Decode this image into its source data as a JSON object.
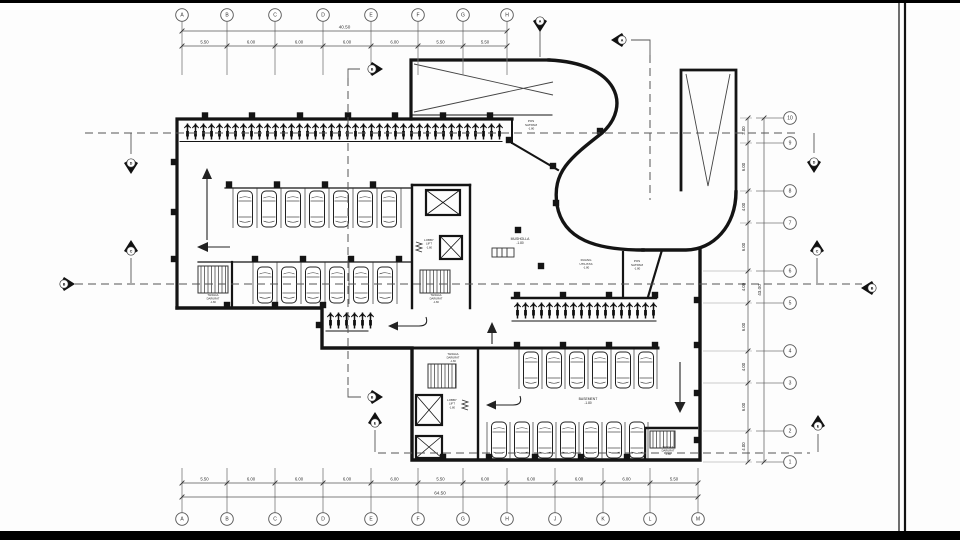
{
  "sheet": {
    "background": "#fdfdfd",
    "line_color": "#141414",
    "dash_color": "#555555"
  },
  "grid": {
    "top": {
      "labels": [
        "A",
        "B",
        "C",
        "D",
        "E",
        "F",
        "G",
        "H"
      ],
      "dims": [
        "5.50",
        "6.00",
        "6.00",
        "6.00",
        "6.00",
        "5.50",
        "5.50"
      ],
      "total": "40.50"
    },
    "bottom": {
      "labels": [
        "A",
        "B",
        "C",
        "D",
        "E",
        "F",
        "G",
        "H",
        "J",
        "K",
        "L",
        "M"
      ],
      "dims": [
        "5.50",
        "6.00",
        "6.00",
        "6.00",
        "6.00",
        "5.50",
        "6.00",
        "6.00",
        "6.00",
        "6.00",
        "5.50"
      ],
      "total": "64.50"
    },
    "right": {
      "labels": [
        "10",
        "9",
        "8",
        "7",
        "6",
        "5",
        "4",
        "3",
        "2",
        "1"
      ],
      "dims": [
        "3.00",
        "6.00",
        "4.00",
        "6.00",
        "4.00",
        "6.00",
        "4.00",
        "6.00",
        "4.00"
      ],
      "total": "43.00"
    }
  },
  "rooms": [
    {
      "id": "musholla",
      "lines": [
        "MUSHOLLA"
      ],
      "level": "-1.80",
      "x": 520,
      "y": 240,
      "fs": 3.4
    },
    {
      "id": "ruang-utilitas",
      "lines": [
        "RUANG",
        "UTILITAS"
      ],
      "level": "-1.80",
      "x": 586,
      "y": 261,
      "fs": 3.0
    },
    {
      "id": "pos-satpam-east",
      "lines": [
        "POS",
        "SATPAM"
      ],
      "level": "-1.80",
      "x": 637,
      "y": 262,
      "fs": 3.0
    },
    {
      "id": "pos-satpam-north",
      "lines": [
        "POS",
        "SATPAM"
      ],
      "level": "-1.80",
      "x": 531,
      "y": 122,
      "fs": 3.0
    },
    {
      "id": "basement",
      "lines": [
        "BASEMENT"
      ],
      "level": "-1.80",
      "x": 588,
      "y": 400,
      "fs": 3.4
    },
    {
      "id": "tangga-darurat-1",
      "lines": [
        "TANGGA",
        "DARURAT"
      ],
      "level": "-1.80",
      "x": 213,
      "y": 296,
      "fs": 2.7
    },
    {
      "id": "tangga-darurat-2",
      "lines": [
        "TANGGA",
        "DARURAT"
      ],
      "level": "-1.80",
      "x": 436,
      "y": 296,
      "fs": 2.7
    },
    {
      "id": "tangga-darurat-3",
      "lines": [
        "TANGGA",
        "DARURAT"
      ],
      "level": "-1.80",
      "x": 453,
      "y": 355,
      "fs": 2.7
    },
    {
      "id": "tangga-darurat-4",
      "lines": [
        "TANGGA",
        "DARURAT"
      ],
      "level": "-1.80",
      "x": 668,
      "y": 448,
      "fs": 2.7
    },
    {
      "id": "lobby-lift-1",
      "lines": [
        "LOBBY",
        "LIFT"
      ],
      "level": "-1.80",
      "x": 429,
      "y": 241,
      "fs": 2.9
    },
    {
      "id": "lobby-lift-2",
      "lines": [
        "LOBBY",
        "LIFT"
      ],
      "level": "-1.80",
      "x": 452,
      "y": 401,
      "fs": 2.9
    }
  ],
  "section_markers": [
    {
      "letter": "A",
      "x": 540,
      "y": 21,
      "dir": "down"
    },
    {
      "letter": "A",
      "x": 622,
      "y": 40,
      "dir": "left"
    },
    {
      "letter": "B",
      "x": 372,
      "y": 69,
      "dir": "right"
    },
    {
      "letter": "D",
      "x": 131,
      "y": 163,
      "dir": "down"
    },
    {
      "letter": "D",
      "x": 814,
      "y": 162,
      "dir": "down"
    },
    {
      "letter": "C",
      "x": 131,
      "y": 251,
      "dir": "up"
    },
    {
      "letter": "C",
      "x": 817,
      "y": 251,
      "dir": "up"
    },
    {
      "letter": "B",
      "x": 64,
      "y": 284,
      "dir": "right"
    },
    {
      "letter": "B",
      "x": 872,
      "y": 288,
      "dir": "left"
    },
    {
      "letter": "B",
      "x": 372,
      "y": 397,
      "dir": "right"
    },
    {
      "letter": "E",
      "x": 375,
      "y": 423,
      "dir": "up"
    },
    {
      "letter": "E",
      "x": 818,
      "y": 426,
      "dir": "up"
    }
  ]
}
